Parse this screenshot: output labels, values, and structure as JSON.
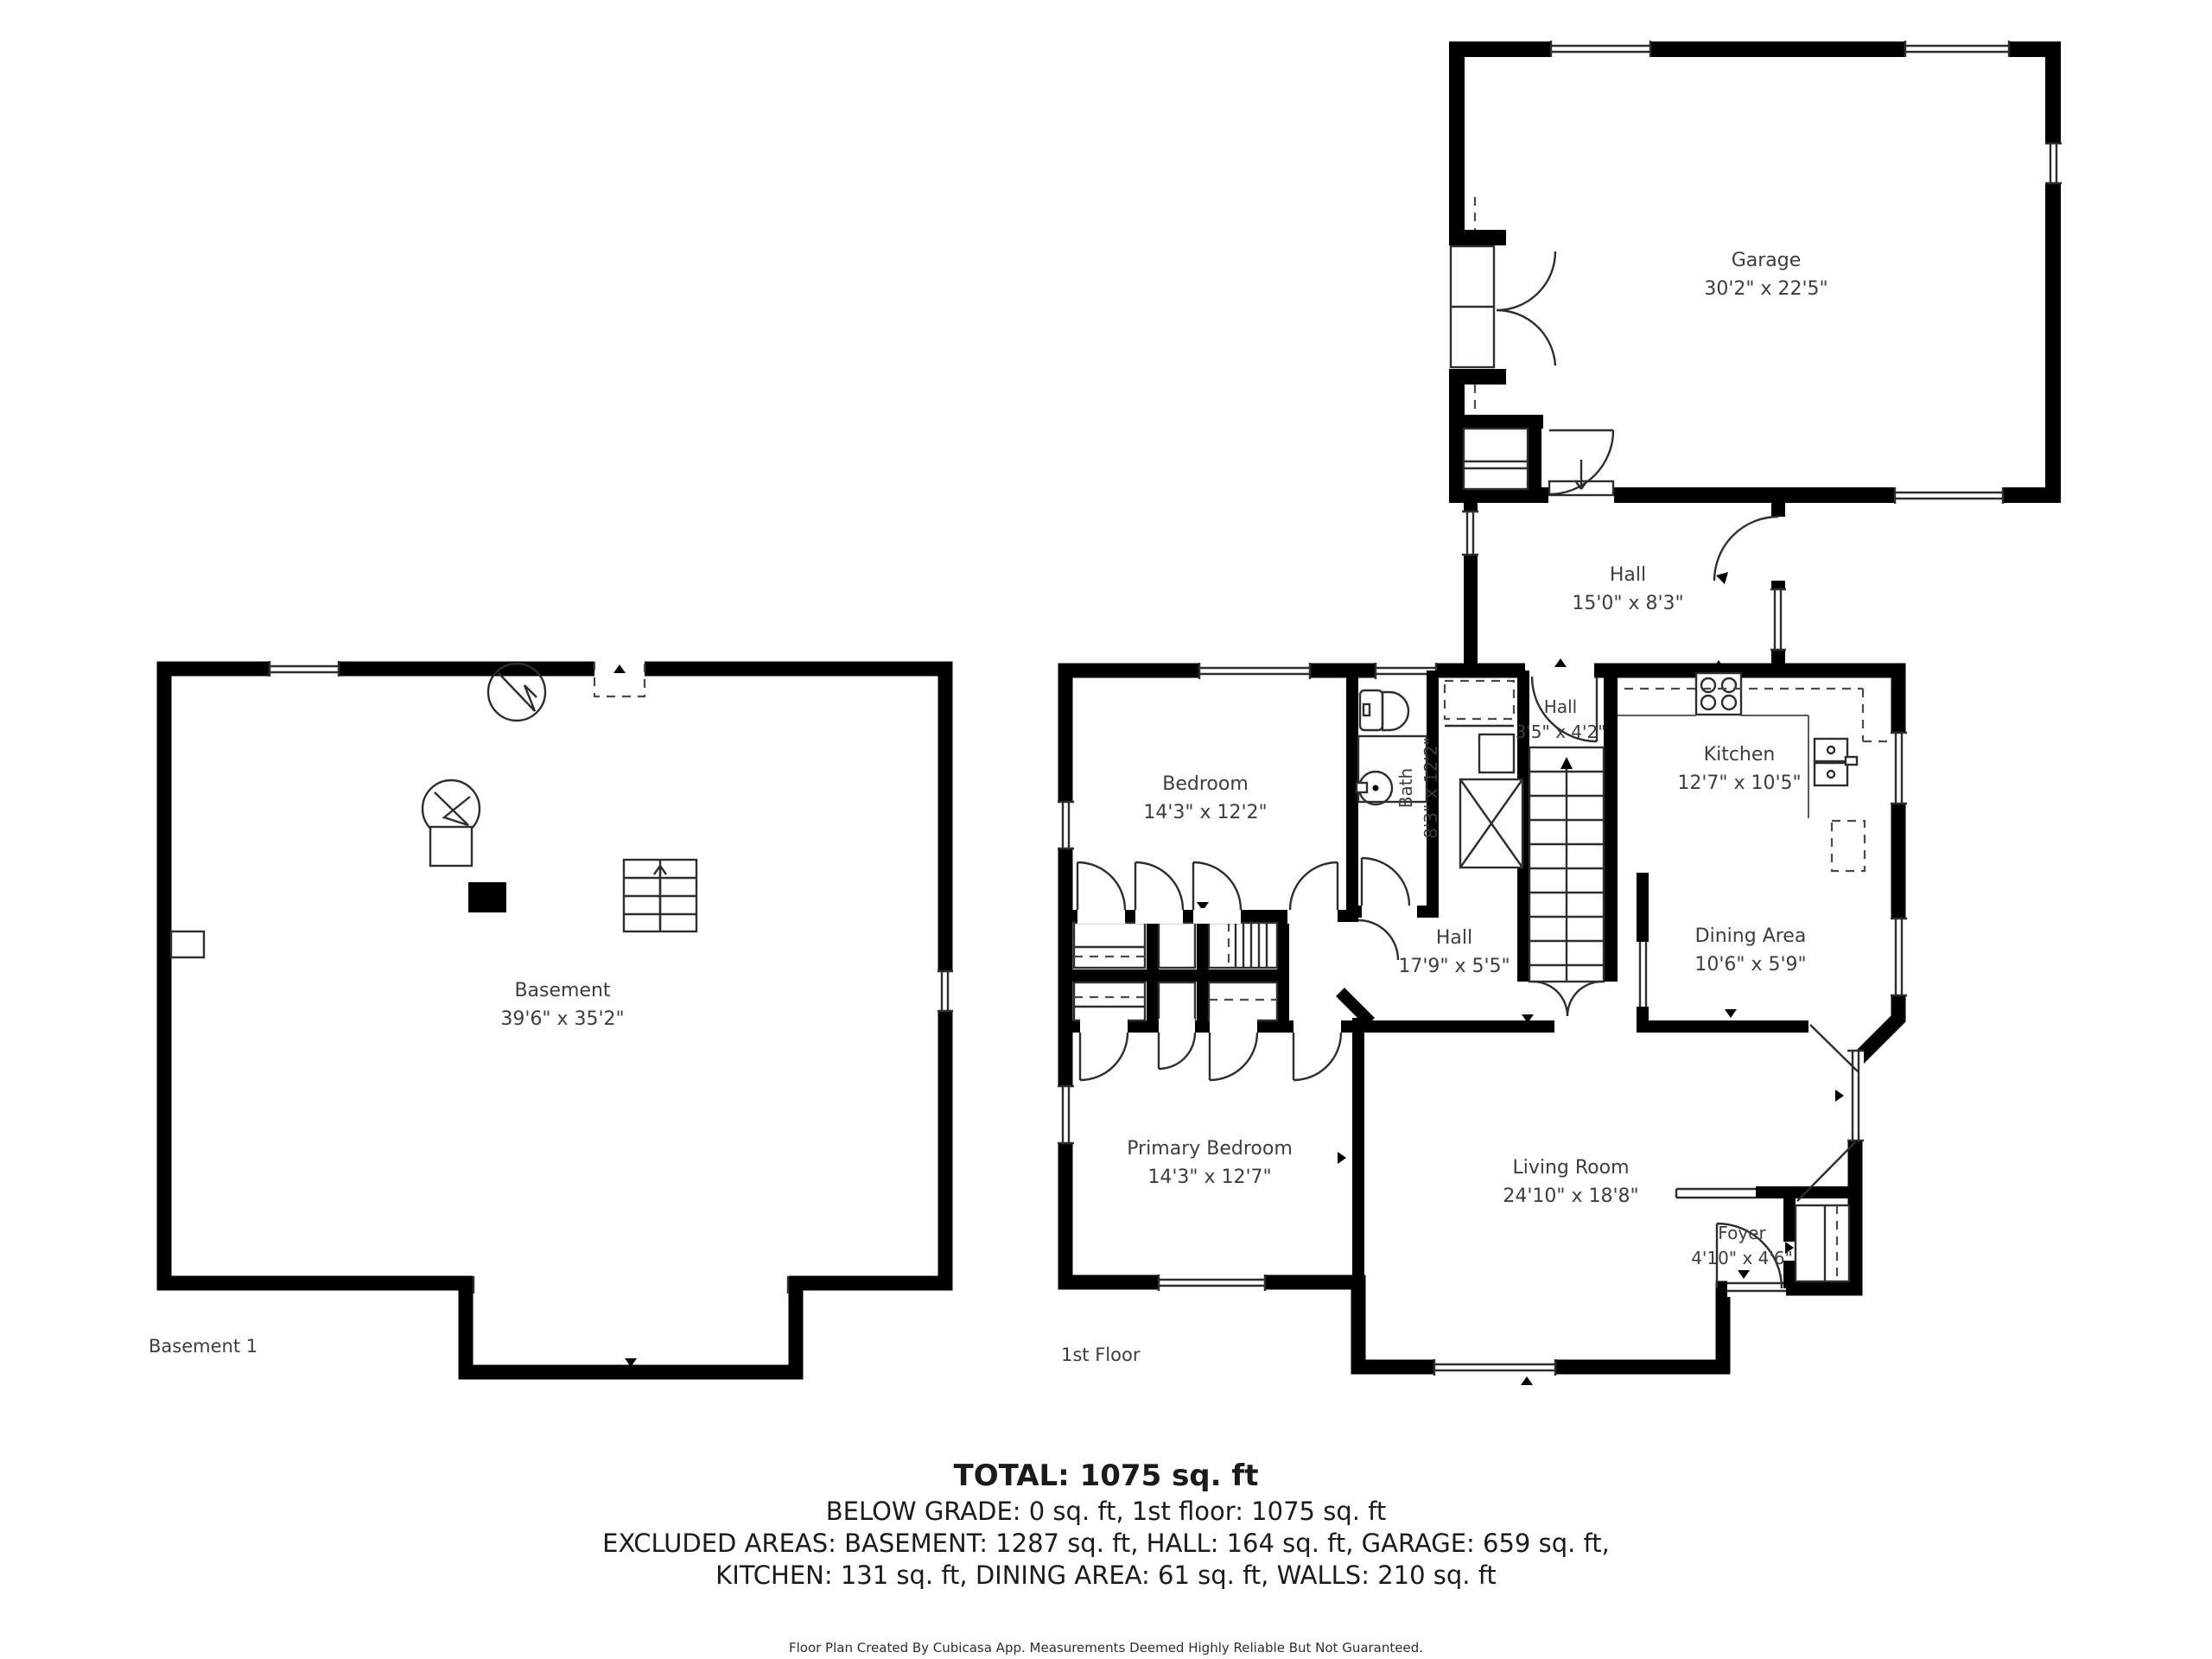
{
  "plan": {
    "floor_labels": {
      "basement": "Basement 1",
      "first": "1st Floor"
    },
    "rooms": {
      "basement": {
        "name": "Basement",
        "dims": "39'6\" x 35'2\""
      },
      "garage": {
        "name": "Garage",
        "dims": "30'2\" x 22'5\""
      },
      "hall_connector": {
        "name": "Hall",
        "dims": "15'0\" x 8'3\""
      },
      "bedroom": {
        "name": "Bedroom",
        "dims": "14'3\" x 12'2\""
      },
      "bath": {
        "name": "Bath",
        "dims": "8'3\" x 12'2\""
      },
      "hall_small": {
        "name": "Hall",
        "dims": "3'5\" x 4'2\""
      },
      "kitchen": {
        "name": "Kitchen",
        "dims": "12'7\" x 10'5\""
      },
      "dining_area": {
        "name": "Dining Area",
        "dims": "10'6\" x 5'9\""
      },
      "hall_main": {
        "name": "Hall",
        "dims": "17'9\" x 5'5\""
      },
      "primary_bedroom": {
        "name": "Primary Bedroom",
        "dims": "14'3\" x 12'7\""
      },
      "living_room": {
        "name": "Living Room",
        "dims": "24'10\" x 18'8\""
      },
      "foyer": {
        "name": "Foyer",
        "dims": "4'10\" x 4'6\""
      }
    },
    "summary": {
      "total": "TOTAL: 1075 sq. ft",
      "below_grade": "BELOW GRADE: 0 sq. ft, 1st floor: 1075 sq. ft",
      "excluded_1": "EXCLUDED AREAS: BASEMENT: 1287 sq. ft, HALL: 164 sq. ft, GARAGE: 659 sq. ft,",
      "excluded_2": "KITCHEN: 131 sq. ft, DINING AREA: 61 sq. ft, WALLS: 210 sq. ft",
      "footer": "Floor Plan Created By Cubicasa App. Measurements Deemed Highly Reliable But Not Guaranteed."
    },
    "colors": {
      "wall": "#000000",
      "label": "#3d3d3d",
      "text": "#1b1b1b"
    }
  }
}
